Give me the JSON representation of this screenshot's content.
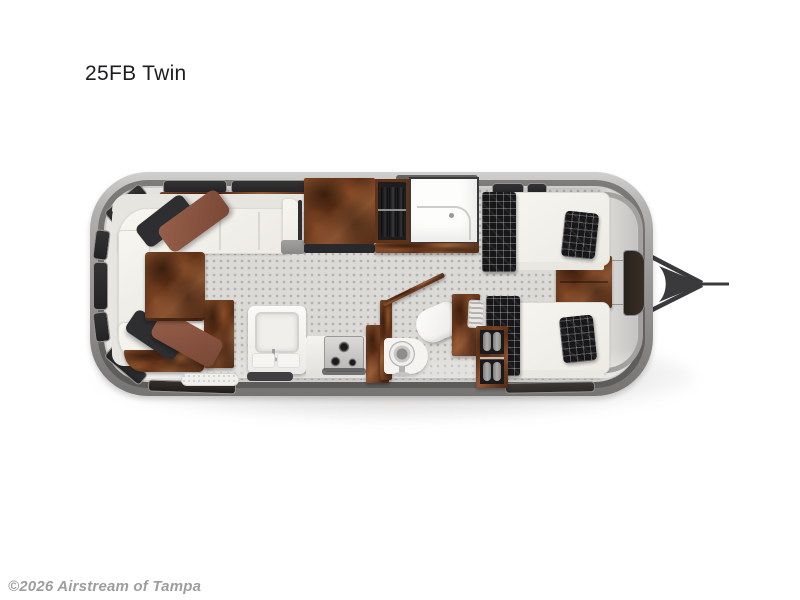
{
  "page": {
    "title": "25FB Twin",
    "watermark": "©2026 Airstream of Tampa"
  },
  "floorplan": {
    "label": "Airstream 25FB Twin floor plan, top-down view",
    "icons": [
      "wraparound-sofa-icon",
      "throw-pillow-icon",
      "dinette-table-icon",
      "galley-sink-icon",
      "cooktop-icon",
      "kitchen-cabinet-icon",
      "wardrobe-icon",
      "hanging-closet-icon",
      "shower-icon",
      "toilet-icon",
      "vanity-pedestal-icon",
      "twin-bed-icon",
      "plaid-runner-icon",
      "plaid-pillow-icon",
      "nightstand-icon",
      "storage-shelf-icon",
      "entry-step-icon",
      "floor-mat-icon",
      "window-icon",
      "roof-vent-icon",
      "tow-hitch-icon"
    ]
  },
  "colors": {
    "page-bg": "#ffffff",
    "title-color": "#1d1d1f",
    "watermark-color": "#9d9d9d",
    "shell-mid": "#9a9896",
    "floor": "#dbdad7",
    "floor-dot": "#b3b2af",
    "uph": "#f4f3ee",
    "wood": "#6b3a1e",
    "plaid": "#17171a",
    "pillow-brown": "#8a5340",
    "pillow-dark": "#2e2e31",
    "hitch": "#3a3a3c"
  }
}
